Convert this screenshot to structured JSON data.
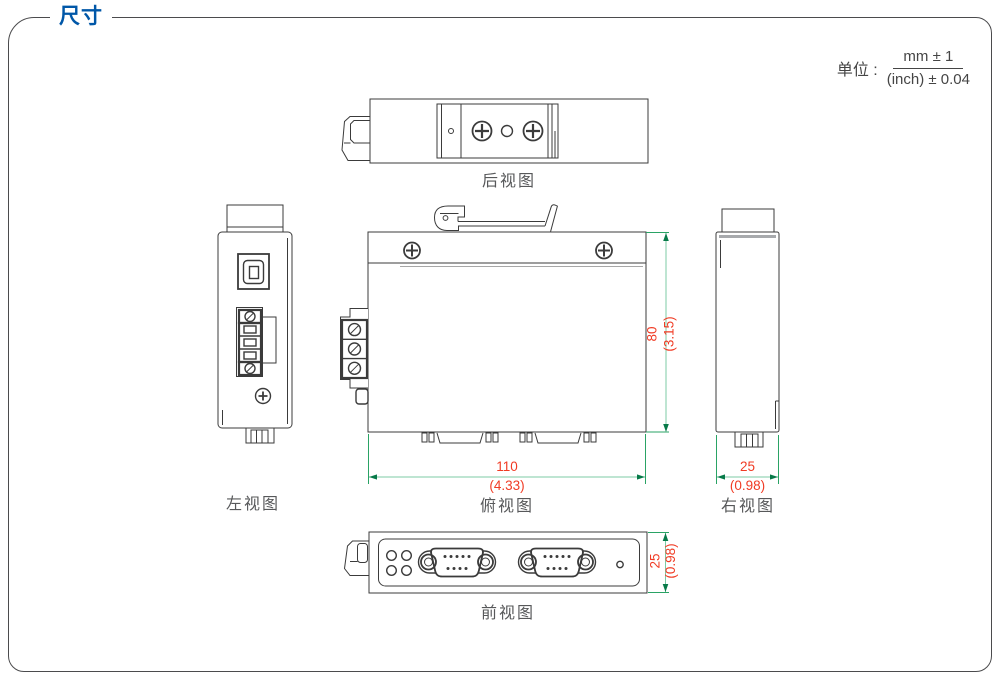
{
  "page": {
    "title": "尺寸"
  },
  "unit": {
    "label": "单位 :",
    "numerator": "mm ± 1",
    "denominator": "(inch) ± 0.04"
  },
  "views": {
    "rear": {
      "label": "后视图"
    },
    "left": {
      "label": "左视图"
    },
    "top": {
      "label": "俯视图"
    },
    "right": {
      "label": "右视图"
    },
    "front": {
      "label": "前视图"
    }
  },
  "dimensions": {
    "width": {
      "mm": "110",
      "inch": "(4.33)"
    },
    "height": {
      "mm": "80",
      "inch": "(3.15)"
    },
    "depth": {
      "mm": "25",
      "inch": "(0.98)"
    }
  },
  "colors": {
    "title_blue": "#0057a8",
    "dimension_red": "#f03b24",
    "dimension_green": "#2aa365",
    "line_dark": "#3b3b3b",
    "label_gray": "#57585a"
  }
}
